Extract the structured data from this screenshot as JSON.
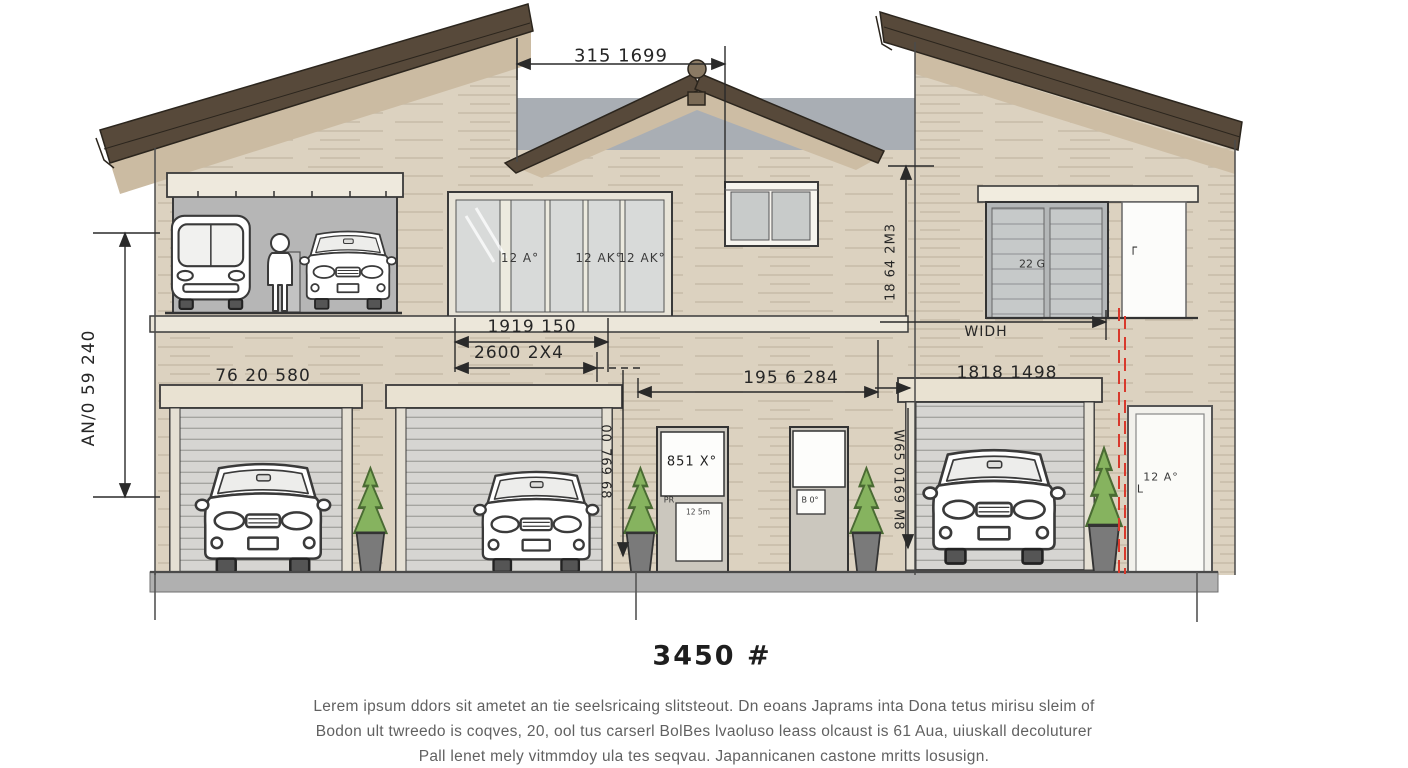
{
  "drawing": {
    "type": "architectural-elevation",
    "colors": {
      "wall": "#dcd2c0",
      "roof_fascia": "#57493a",
      "roof_shadow": "#cbbba2",
      "sky_band": "#a9aeb4",
      "shutter": "#d6d5d2",
      "ground": "#b0b0b0",
      "red_dashed_line": "#d8392c",
      "ink": "#2a2a2a"
    }
  },
  "dimensions": {
    "top_width": "315 1699",
    "left_height": "AN/0 59 240",
    "garage_left": "76 20 580",
    "window_upper": "1919 150",
    "window_lower": "2600 2X4",
    "center_span": "195 6 284",
    "garage_right": "1818 1498",
    "width_tag": "WIDH",
    "gable_height": "18 64 2M3",
    "door_left_height": "00 769 68",
    "door_right_height": "W65 0169 M8"
  },
  "glass_labels": {
    "pane2": "12 A°",
    "pane4": "12 AK°",
    "pane5": "12 AK°"
  },
  "door_labels": {
    "upper_double": "22 G",
    "upper_corner_mark": "┌",
    "entry_sign": "851 X°",
    "entry_small": "PR",
    "entry_plaque": "12 5m",
    "entry2_plaque": "B 0°",
    "side_door": "12 A°",
    "side_door_mark": "L"
  },
  "footer": {
    "area_value": "3450 #",
    "note_line1": "Lerem ipsum ddors sit ametet an tie seelsricaing slitsteout. Dn eoans Japrams inta Dona tetus mirisu sleim of",
    "note_line2": "Bodon ult twreedo is coqves, 20, ool tus carserl BolBes lvaoluso leass olcaust is 61 Aua, uiuskall decoluturer",
    "note_line3": "Pall lenet mely vitmmdoy ula tes seqvau. Japannicanen castone mritts losusign."
  }
}
